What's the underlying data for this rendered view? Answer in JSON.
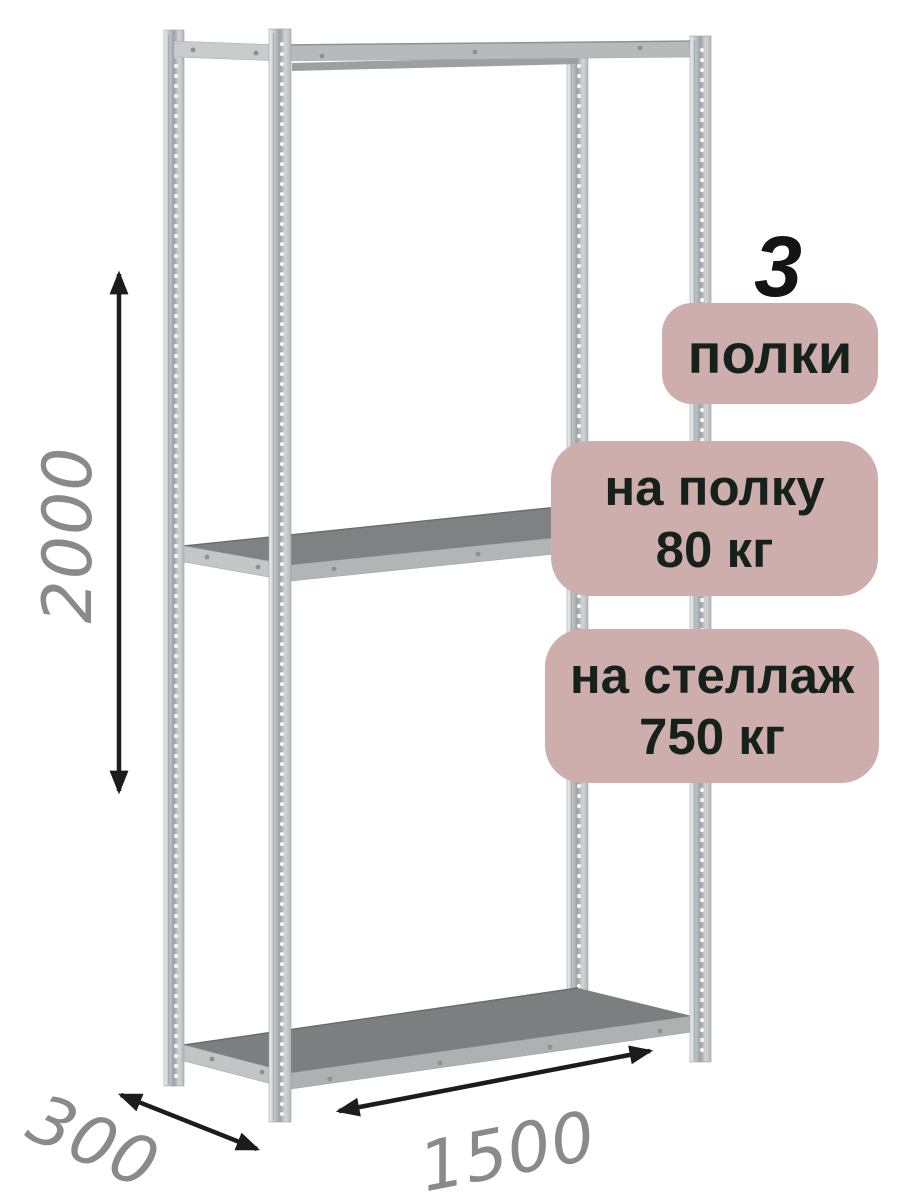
{
  "product": {
    "name": "metal-shelving-rack",
    "shelf_count": "3",
    "badges": {
      "shelves": {
        "label": "полки"
      },
      "per_shelf": {
        "line1": "на полку",
        "line2": "80 кг"
      },
      "per_rack": {
        "line1": "на стеллаж",
        "line2": "750 кг"
      }
    },
    "dimensions": {
      "height_mm": "2000",
      "depth_mm": "300",
      "width_mm": "1500"
    }
  },
  "colors": {
    "badge_bg": "#cdaeac",
    "badge_text": "#17211b",
    "count_text": "#141414",
    "dimension_text": "#8a8a8a",
    "arrow": "#1c1c1c",
    "metal_light": "#f0f1f2",
    "metal_dark": "#9ba1a6",
    "shelf_top": "#7f8183"
  }
}
